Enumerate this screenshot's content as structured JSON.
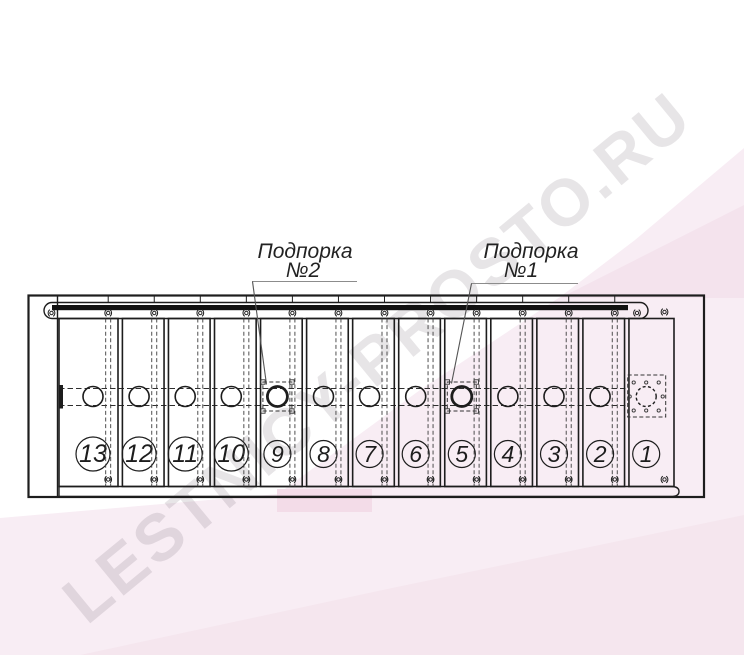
{
  "watermark": {
    "text": "LESTNICY-PROSTO.RU"
  },
  "drawing": {
    "labels": {
      "support2": {
        "title": "Подпорка",
        "subtitle": "№2"
      },
      "support1": {
        "title": "Подпорка",
        "subtitle": "№1"
      }
    },
    "planks": [
      {
        "number": "13"
      },
      {
        "number": "12"
      },
      {
        "number": "11"
      },
      {
        "number": "10"
      },
      {
        "number": "9",
        "support": "2"
      },
      {
        "number": "8"
      },
      {
        "number": "7"
      },
      {
        "number": "6"
      },
      {
        "number": "5",
        "support": "1"
      },
      {
        "number": "4"
      },
      {
        "number": "3"
      },
      {
        "number": "2"
      },
      {
        "number": "1",
        "end_detail": true
      }
    ]
  },
  "colors": {
    "line": "#1d1d1d",
    "dashed": "#3c3c3c",
    "leader": "#555555",
    "underline": "#8c8c8c",
    "pink_light": "#f8edf4",
    "pink_mid": "#f4e3ed",
    "pink_deep": "#f3dce8",
    "pink_bottom": "#f5e6ee"
  }
}
